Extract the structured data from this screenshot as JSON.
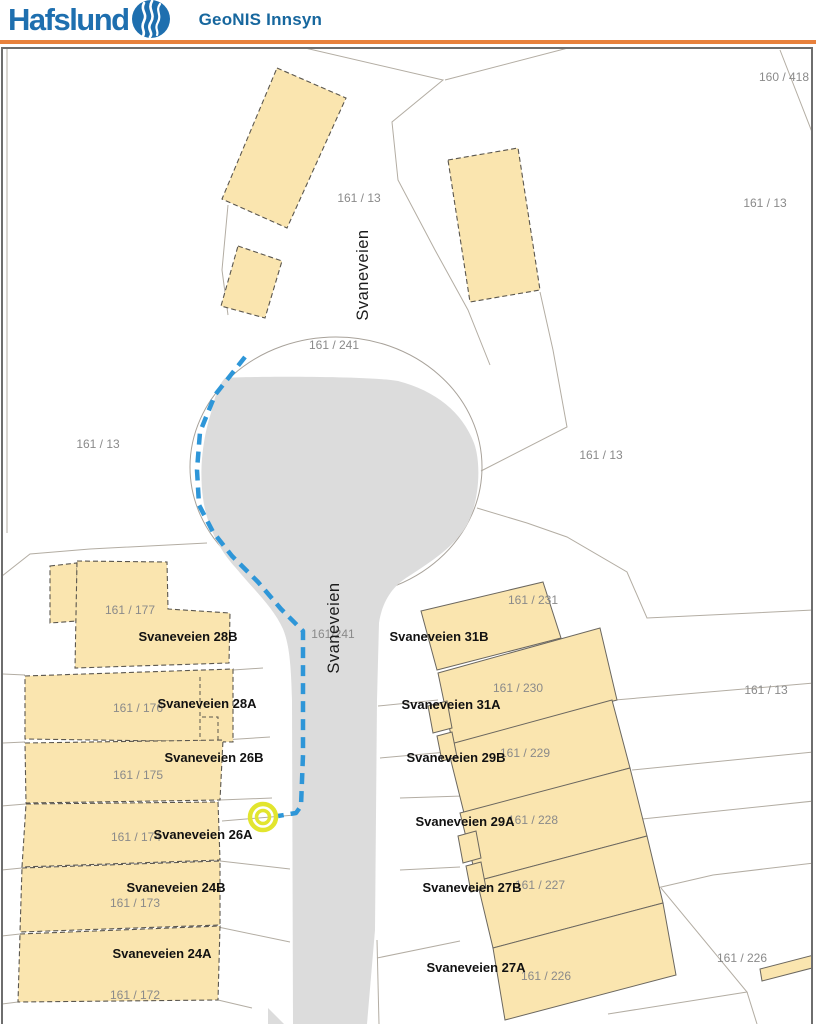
{
  "header": {
    "brand": "Hafslund",
    "app_title": "GeoNIS Innsyn",
    "logo_icon": "hafslund-wave-logo"
  },
  "colors": {
    "brand-blue": "#1E6FAF",
    "title-blue": "#17679E",
    "accent-orange": "#E8813C",
    "map-border": "#6e6e6e",
    "parcel-line": "#b3ada3",
    "building-fill": "#FAE5AF",
    "building-stroke": "#5a564e",
    "road-fill": "#DCDCDC",
    "route-blue": "#2E96D8",
    "marker-yellow": "#E2E52E",
    "parcel-label": "#8a8a8a",
    "address-label": "#111111"
  },
  "map": {
    "street_labels": [
      {
        "text": "Svaneveien"
      },
      {
        "text": "Svaneveien"
      }
    ],
    "parcel_labels": [
      {
        "text": "160 / 418"
      },
      {
        "text": "161 / 13"
      },
      {
        "text": "161 / 13"
      },
      {
        "text": "161 / 241"
      },
      {
        "text": "161 / 13"
      },
      {
        "text": "161 / 13"
      },
      {
        "text": "161 / 177"
      },
      {
        "text": "161/241"
      },
      {
        "text": "161 / 231"
      },
      {
        "text": "161 / 230"
      },
      {
        "text": "161 / 13"
      },
      {
        "text": "161 / 176"
      },
      {
        "text": "161 / 229"
      },
      {
        "text": "161 / 175"
      },
      {
        "text": "161 / 228"
      },
      {
        "text": "161 / 174"
      },
      {
        "text": "161 / 227"
      },
      {
        "text": "161 / 173"
      },
      {
        "text": "161 / 226"
      },
      {
        "text": "161 / 226"
      },
      {
        "text": "161 / 172"
      }
    ],
    "address_labels": [
      {
        "text": "Svaneveien 28B"
      },
      {
        "text": "Svaneveien 28A"
      },
      {
        "text": "Svaneveien 26B"
      },
      {
        "text": "Svaneveien 26A"
      },
      {
        "text": "Svaneveien 24B"
      },
      {
        "text": "Svaneveien 24A"
      },
      {
        "text": "Svaneveien 31B"
      },
      {
        "text": "Svaneveien 31A"
      },
      {
        "text": "Svaneveien 29B"
      },
      {
        "text": "Svaneveien 29A"
      },
      {
        "text": "Svaneveien 27B"
      },
      {
        "text": "Svaneveien 27A"
      }
    ],
    "marker": "selected-point-marker",
    "route": "selected-cable-route"
  }
}
